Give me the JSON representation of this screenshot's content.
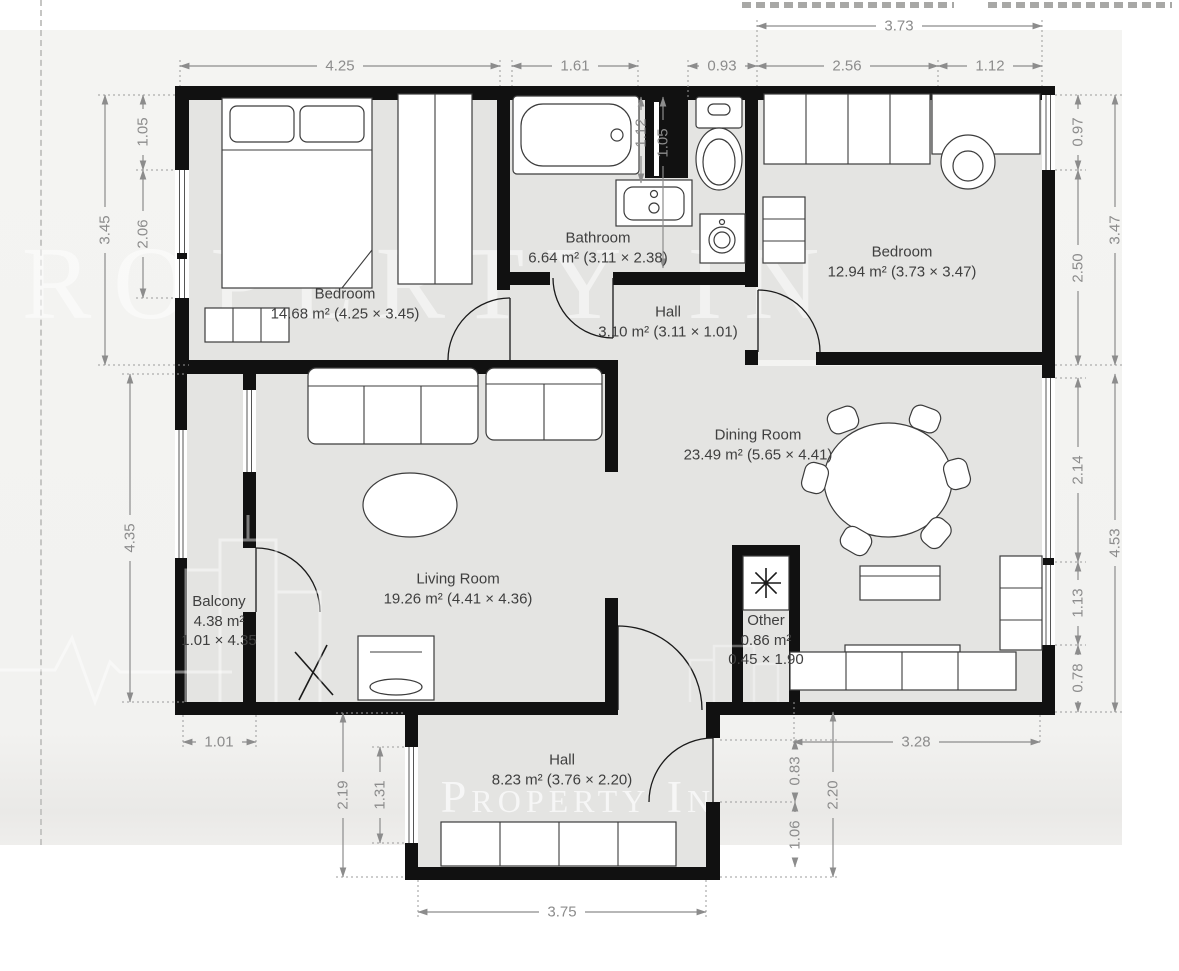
{
  "watermark": {
    "large": "PROPERTY IN",
    "small": "Property In"
  },
  "rooms": {
    "bedroom1": {
      "name": "Bedroom",
      "area": "14.68 m² (4.25 × 3.45)"
    },
    "bathroom": {
      "name": "Bathroom",
      "area": "6.64 m² (3.11 × 2.38)"
    },
    "hall_top": {
      "name": "Hall",
      "area": "3.10 m² (3.11 × 1.01)"
    },
    "bedroom2": {
      "name": "Bedroom",
      "area": "12.94 m² (3.73 × 3.47)"
    },
    "dining": {
      "name": "Dining Room",
      "area": "23.49 m² (5.65 × 4.41)"
    },
    "living": {
      "name": "Living Room",
      "area": "19.26 m² (4.41 × 4.36)"
    },
    "balcony": {
      "name": "Balcony",
      "area": "4.38 m²",
      "size": "1.01 × 4.35"
    },
    "other": {
      "name": "Other",
      "area": "0.86 m²",
      "size": "0.45 × 1.90"
    },
    "hall_bottom": {
      "name": "Hall",
      "area": "8.23 m² (3.76 × 2.20)"
    }
  },
  "dimensions": {
    "t425": "4.25",
    "t161": "1.61",
    "t093": "0.93",
    "t256": "2.56",
    "t112": "1.12",
    "t373": "3.73",
    "l105": "1.05",
    "l206": "2.06",
    "l345": "3.45",
    "l435": "4.35",
    "l219": "2.19",
    "l131": "1.31",
    "b101": "1.01",
    "bath112": "1.12",
    "bath105": "1.05",
    "r097": "0.97",
    "r250": "2.50",
    "r347": "3.47",
    "r214": "2.14",
    "r113": "1.13",
    "r078": "0.78",
    "r453": "4.53",
    "h083": "0.83",
    "h106": "1.06",
    "h220": "2.20",
    "h328": "3.28",
    "h375": "3.75"
  },
  "colors": {
    "wall": "#111111",
    "floor": "#e4e4e2",
    "sheet": "#f3f3f1",
    "dimension": "#8c8c8c",
    "label": "#3f3f3f"
  }
}
